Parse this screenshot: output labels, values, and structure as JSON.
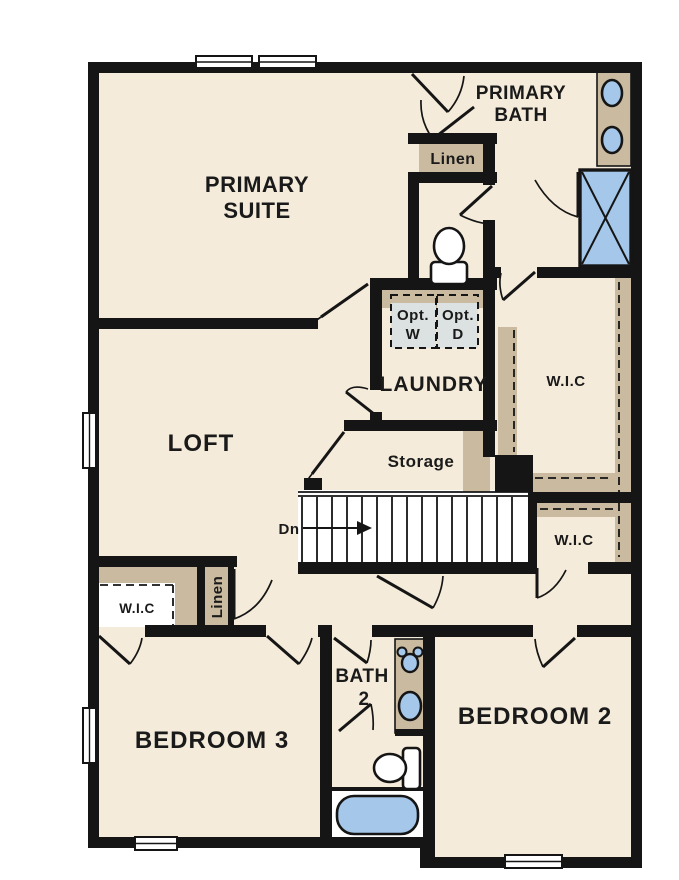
{
  "plan": {
    "title": "second-floor-plan",
    "colors": {
      "paper": "#ffffff",
      "floor": "#f4ebda",
      "wall": "#151515",
      "casework": "#c9baa0",
      "fixture": "#a5c7e9",
      "appliance": "#dce2e1",
      "ink": "#1a1a1a"
    },
    "rooms": {
      "primary_suite_line1": "PRIMARY",
      "primary_suite_line2": "SUITE",
      "primary_bath_line1": "PRIMARY",
      "primary_bath_line2": "BATH",
      "loft": "LOFT",
      "laundry": "LAUNDRY",
      "storage": "Storage",
      "bedroom2": "BEDROOM 2",
      "bedroom3": "BEDROOM 3",
      "bath2_line1": "BATH",
      "bath2_line2": "2",
      "wic_primary": "W.I.C",
      "wic_hall": "W.I.C",
      "wic_bedroom3": "W.I.C",
      "linen_bath": "Linen",
      "linen_hall": "Linen",
      "opt_washer_line1": "Opt.",
      "opt_washer_line2": "W",
      "opt_dryer_line1": "Opt.",
      "opt_dryer_line2": "D",
      "stairs_down": "Dn"
    }
  }
}
